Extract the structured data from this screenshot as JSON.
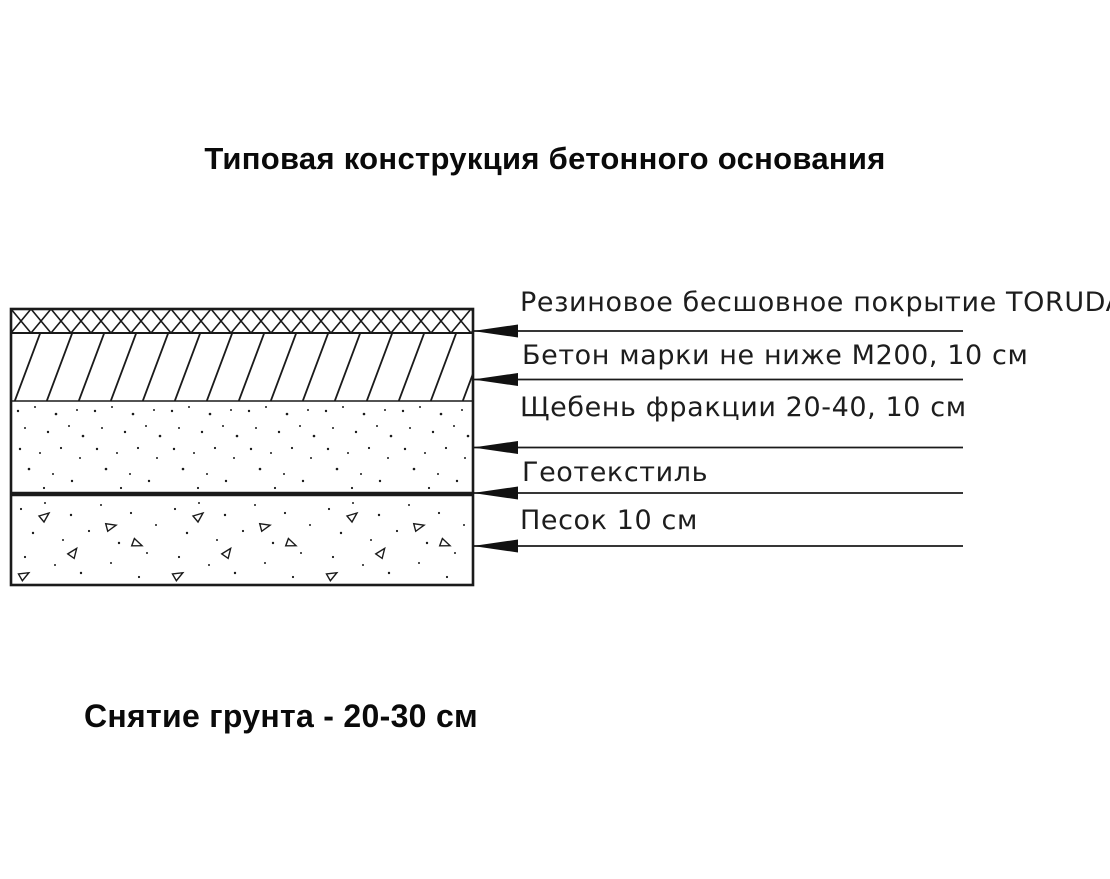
{
  "title": "Типовая конструкция бетонного основания",
  "footnote": "Снятие грунта - 20-30 см",
  "diagram": {
    "name": "Послойная схема бетонного основания",
    "layers": [
      {
        "id": "rubber-coating",
        "label": "Резиновое бесшовное покрытие TORUDA",
        "hatch": "crosshatch-icon",
        "thickness": ""
      },
      {
        "id": "concrete",
        "label": "Бетон марки не ниже М200, 10 см",
        "hatch": "diagonal-hatch-icon",
        "thickness": "10 см"
      },
      {
        "id": "crushed-stone",
        "label": "Щебень фракции 20-40, 10 см",
        "hatch": "stipple-dots-icon",
        "thickness": "10 см"
      },
      {
        "id": "geotextile",
        "label": "Геотекстиль",
        "hatch": "thick-line-icon",
        "thickness": ""
      },
      {
        "id": "sand",
        "label": "Песок 10 см",
        "hatch": "dots-triangles-icon",
        "thickness": "10 см"
      }
    ]
  },
  "colors": {
    "ink": "#1a1a1a",
    "background": "#ffffff",
    "text": "#0a0a0a"
  }
}
